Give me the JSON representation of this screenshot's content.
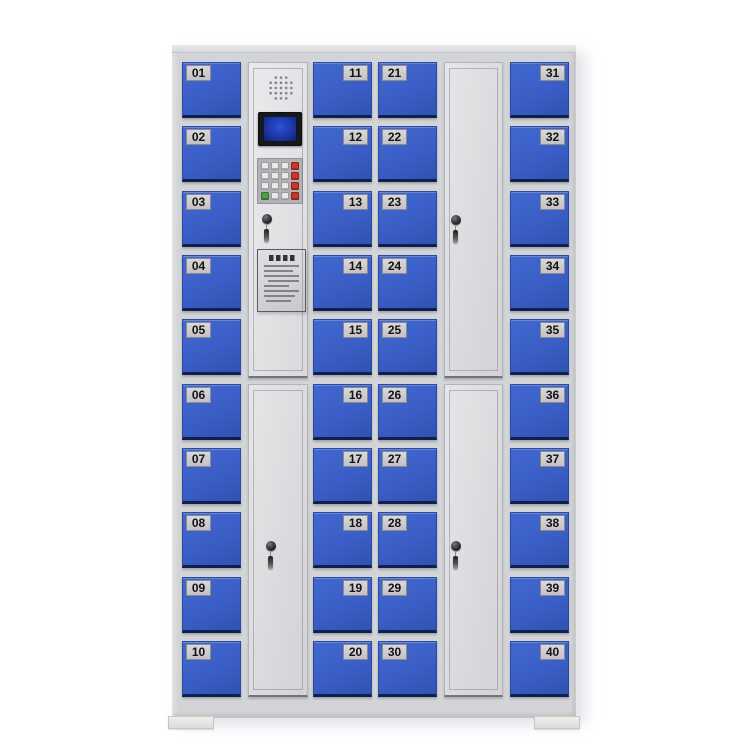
{
  "colors": {
    "bg": "#ffffff",
    "frame": "#d3d4d7",
    "door-blue": "#3a5ec6",
    "door-blue-light": "#4268cf",
    "door-blue-dark": "#3052b0",
    "door-blue-shadow": "#101f4e",
    "door-white": "#dbdbde",
    "door-white-light": "#e2e2e4",
    "plate-bg": "#d9d9db",
    "plate-border": "#8a8a8e",
    "plate-text": "#121212",
    "lcd-bezel": "#17181c",
    "lcd-screen": "#1c38a8",
    "lcd-screen-glow": "#2d53d8",
    "keypad-body": "#b2b2b5",
    "key-white": "#e9e9ea",
    "key-red": "#c8372d",
    "key-green": "#4d9e4f",
    "lock-black": "#222222",
    "foot": "#efefec"
  },
  "cabinet": {
    "locker_columns": [
      {
        "id": "col1",
        "plate_side": "left",
        "numbers": [
          "01",
          "02",
          "03",
          "04",
          "05",
          "06",
          "07",
          "08",
          "09",
          "10"
        ]
      },
      {
        "id": "col3",
        "plate_side": "right",
        "numbers": [
          "11",
          "12",
          "13",
          "14",
          "15",
          "16",
          "17",
          "18",
          "19",
          "20"
        ]
      },
      {
        "id": "col4",
        "plate_side": "left",
        "numbers": [
          "21",
          "22",
          "23",
          "24",
          "25",
          "26",
          "27",
          "28",
          "29",
          "30"
        ]
      },
      {
        "id": "col6",
        "plate_side": "right",
        "numbers": [
          "31",
          "32",
          "33",
          "34",
          "35",
          "36",
          "37",
          "38",
          "39",
          "40"
        ]
      }
    ],
    "control_panel": {
      "components": [
        "speaker",
        "lcd-display",
        "keypad",
        "key-lock",
        "instruction-plate"
      ],
      "keypad": {
        "rows": [
          [
            "white",
            "white",
            "white",
            "red"
          ],
          [
            "white",
            "white",
            "white",
            "red"
          ],
          [
            "white",
            "white",
            "white",
            "red"
          ],
          [
            "green",
            "white",
            "white",
            "red"
          ]
        ]
      }
    },
    "tall_doors": [
      {
        "id": "control-column-bottom-door",
        "lock": true,
        "key_hanging": true
      },
      {
        "id": "right-tall-top-door",
        "lock": true,
        "key_hanging": true
      },
      {
        "id": "right-tall-bottom-door",
        "lock": true,
        "key_hanging": true
      }
    ]
  }
}
